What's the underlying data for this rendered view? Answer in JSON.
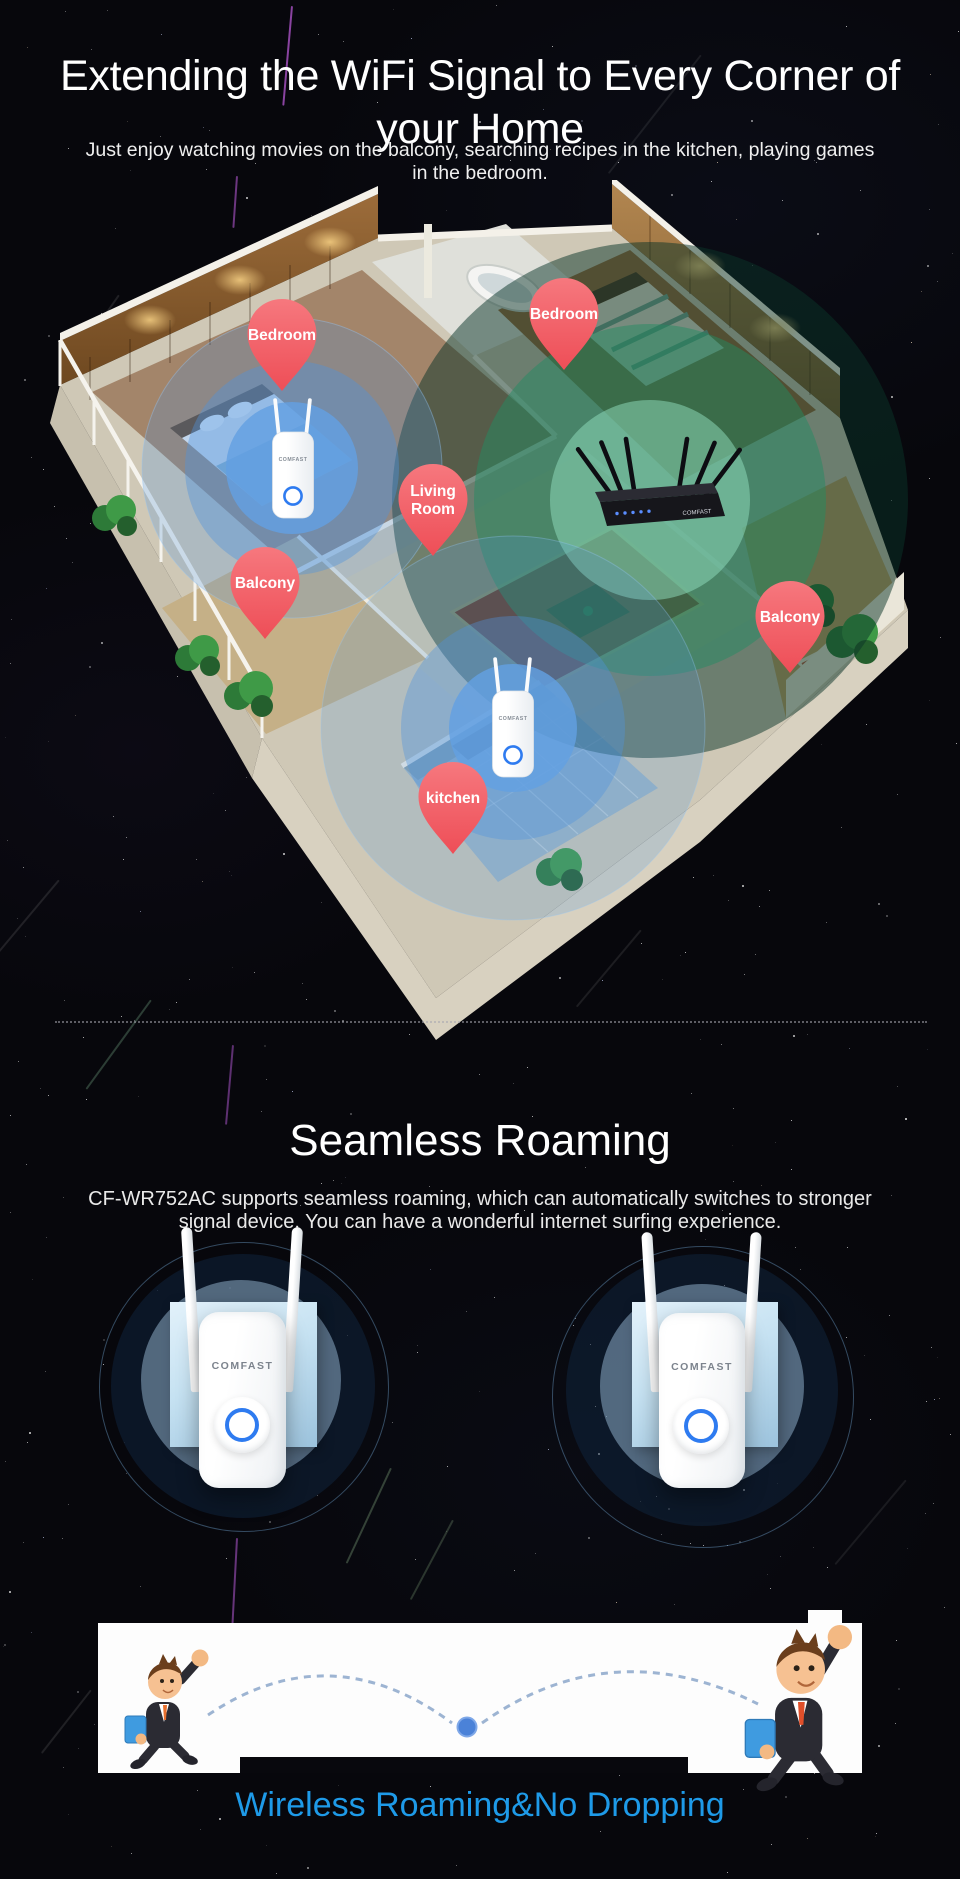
{
  "brand": "COMFAST",
  "colors": {
    "pin_red": "#f25b61",
    "wifi_blue": "#5b9fe2",
    "wifi_green": "#2e9e6f",
    "caption_blue": "#1e9ae8",
    "ring_button_blue": "#2e7bf0"
  },
  "hero": {
    "title_line1": "Extending the WiFi Signal to Every Corner of",
    "title_line2": "your Home",
    "subtitle_line1": "Just enjoy watching movies on the balcony, searching recipes in the kitchen, playing games",
    "subtitle_line2": "in the bedroom."
  },
  "floorplan": {
    "pins": [
      {
        "id": "bedroom-left",
        "label": "Bedroom"
      },
      {
        "id": "bedroom-right",
        "label": "Bedroom"
      },
      {
        "id": "living-room",
        "label": "Living Room",
        "lines": [
          "Living",
          "Room"
        ]
      },
      {
        "id": "balcony-left",
        "label": "Balcony"
      },
      {
        "id": "balcony-right",
        "label": "Balcony"
      },
      {
        "id": "kitchen",
        "label": "kitchen"
      }
    ],
    "devices": [
      {
        "id": "extender-bedroom",
        "type": "wifi-extender",
        "brand": "COMFAST"
      },
      {
        "id": "extender-kitchen",
        "type": "wifi-extender",
        "brand": "COMFAST"
      },
      {
        "id": "router",
        "type": "router",
        "brand": "COMFAST"
      }
    ]
  },
  "roaming": {
    "title": "Seamless Roaming",
    "description_line1": "CF-WR752AC supports seamless roaming, which can automatically switches to stronger",
    "description_line2": "signal device. You can have a wonderful internet surfing experience.",
    "caption": "Wireless Roaming&No Dropping"
  }
}
